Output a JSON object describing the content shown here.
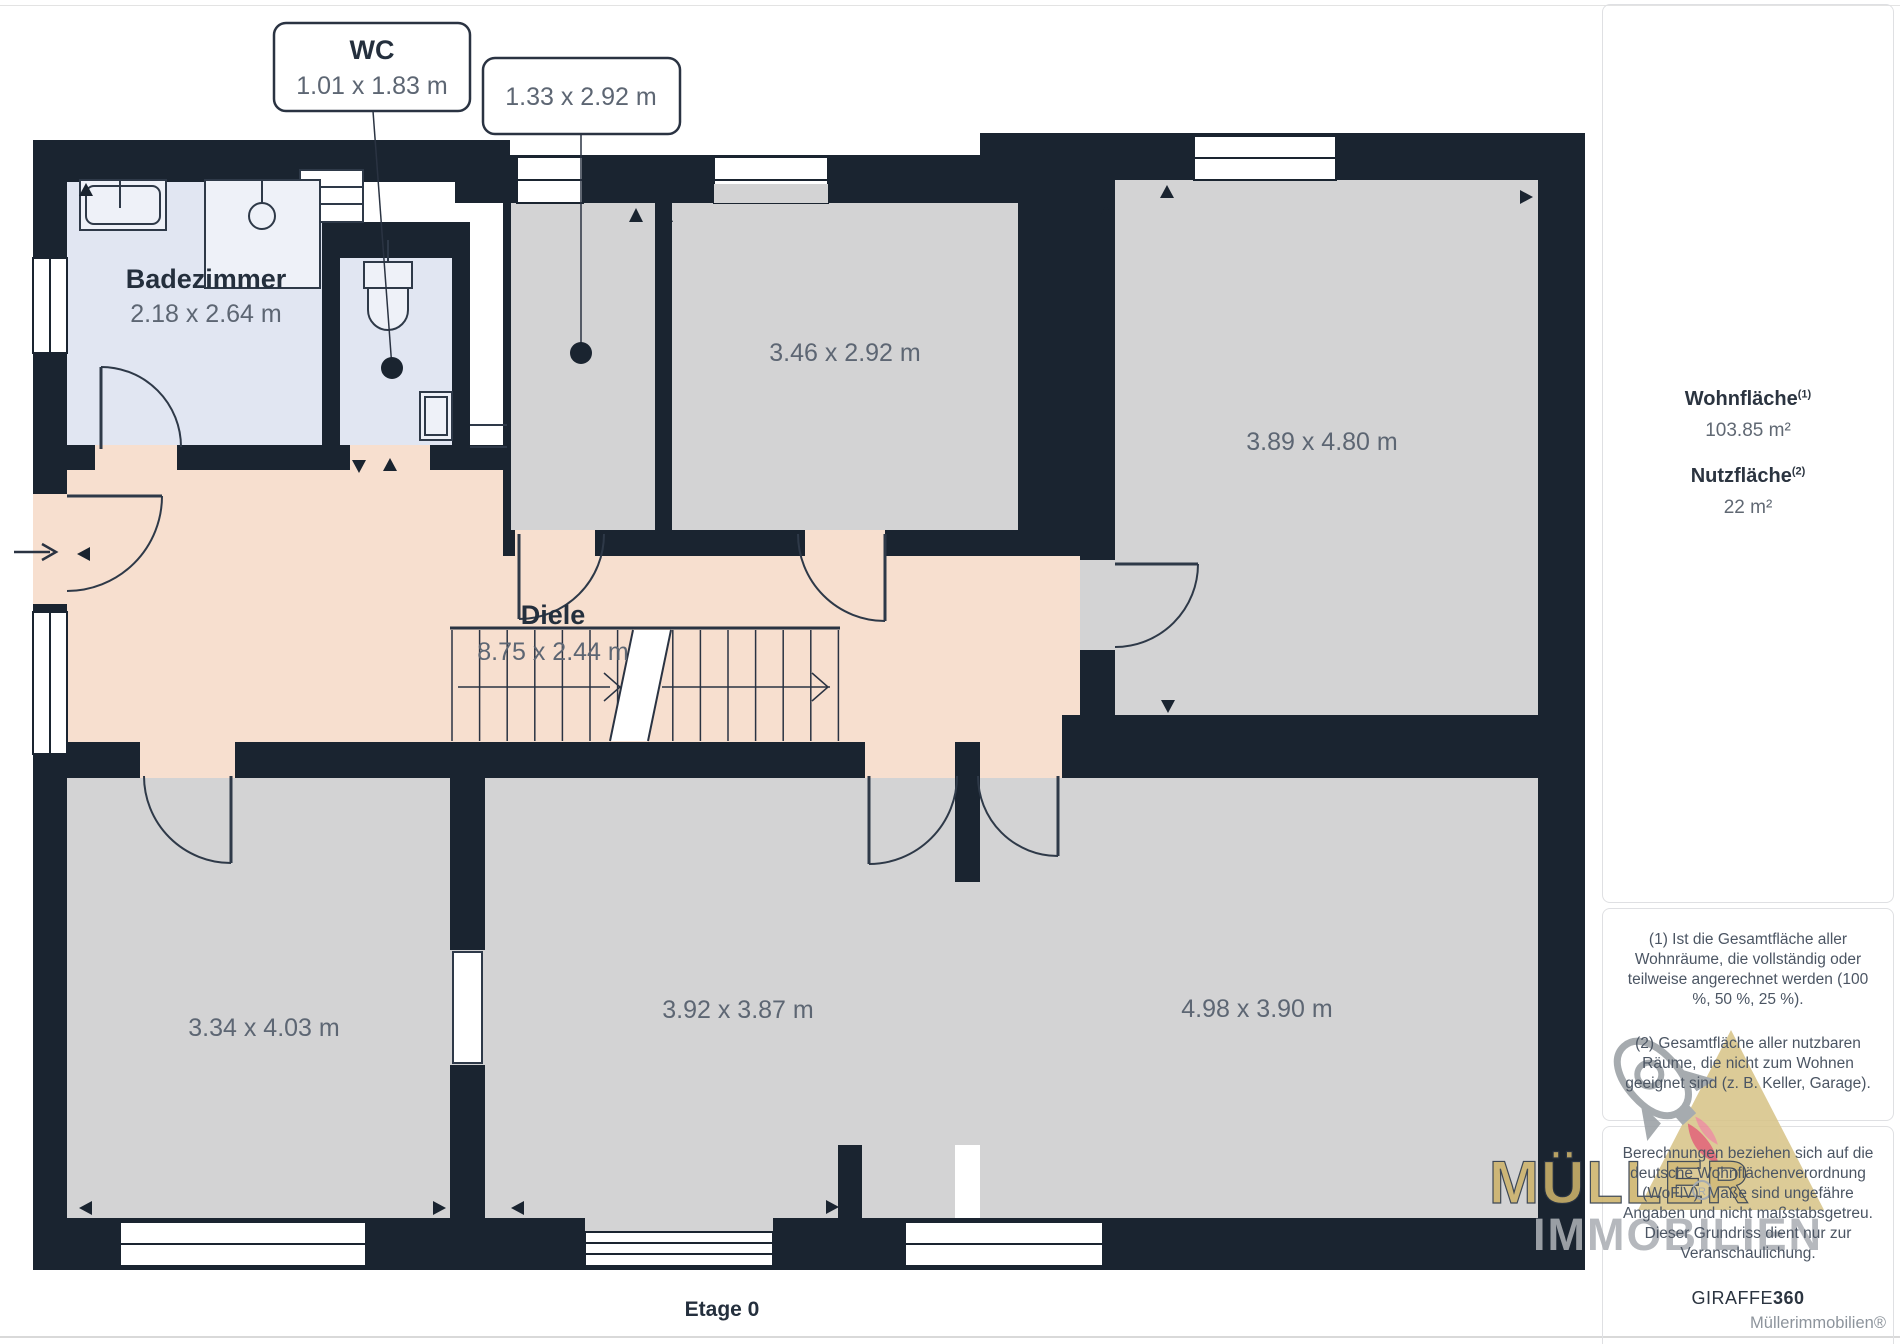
{
  "page": {
    "floor_label": "Etage 0",
    "brand_footer": "Müllerimmobilien®"
  },
  "floorplan": {
    "callouts": [
      {
        "title": "WC",
        "dim": "1.01 x 1.83 m"
      },
      {
        "dim": "1.33 x 2.92 m"
      }
    ],
    "rooms": [
      {
        "name": "Badezimmer",
        "dim": "2.18 x 2.64 m"
      },
      {
        "dim": "3.46 x 2.92 m"
      },
      {
        "dim": "3.89 x 4.80 m"
      },
      {
        "name": "Diele",
        "dim": "8.75 x 2.44 m"
      },
      {
        "dim": "3.34 x 4.03 m"
      },
      {
        "dim": "3.92 x 3.87 m"
      },
      {
        "dim": "4.98 x 3.90 m"
      }
    ]
  },
  "sidebar": {
    "stats": [
      {
        "label": "Wohnfläche",
        "sup": "(1)",
        "value": "103.85 m²"
      },
      {
        "label": "Nutzfläche",
        "sup": "(2)",
        "value": "22 m²"
      }
    ],
    "footnotes": [
      "(1) Ist die Gesamtfläche aller Wohnräume, die vollständig oder teilweise angerechnet werden (100 %, 50 %, 25 %).",
      "(2) Gesamtfläche aller nutzbaren Räume, die nicht zum Wohnen geeignet sind (z. B. Keller, Garage)."
    ],
    "disclaimer": "Berechnungen beziehen sich auf die deutsche Wohnflächenverordnung (WoFlV). Maße sind ungefähre Angaben und nicht maßstabsgetreu. Dieser Grundriss dient nur zur Veranschaulichung.",
    "provider": {
      "name": "GIRAFFE",
      "suffix": "360"
    }
  },
  "watermark": {
    "line1": "MÜLLER",
    "line2": "IMMOBILIEN",
    "registered": "R"
  },
  "colors": {
    "wall": "#1a2430",
    "room_gray": "#d3d3d4",
    "room_wet_blue": "#e1e6f2",
    "hall_peach": "#f7dfcf",
    "label_dark": "#242f3d",
    "label_gray": "#5d6673",
    "card_border": "#dfe0e3",
    "watermark_gold": "#cdb36b",
    "watermark_gray": "#abafb5",
    "watermark_red": "#dd5f6d",
    "watermark_sand": "#d8c489"
  }
}
